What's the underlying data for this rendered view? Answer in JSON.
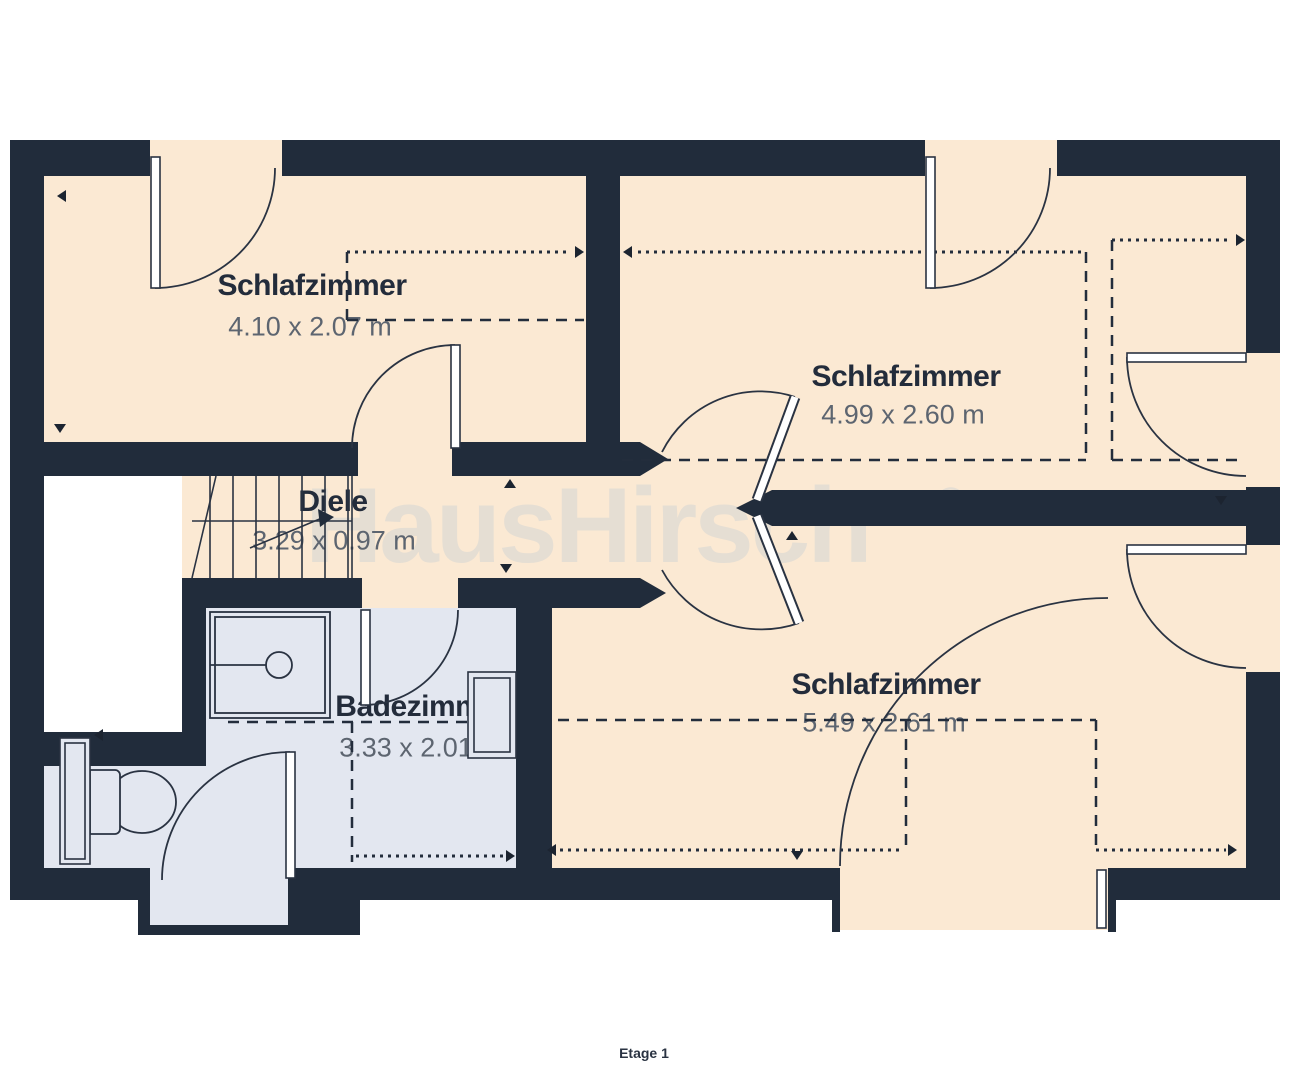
{
  "plan": {
    "brand_watermark": "HausHirsch",
    "registered_mark": "®",
    "floor_label": "Etage 1",
    "rooms": [
      {
        "name": "Schlafzimmer",
        "dimensions": "4.10 x 2.07 m"
      },
      {
        "name": "Schlafzimmer",
        "dimensions": "4.99 x 2.60 m"
      },
      {
        "name": "Diele",
        "dimensions": "3.29 x 0.97 m"
      },
      {
        "name": "Badezimmer",
        "dimensions": "3.33 x 2.01 m"
      },
      {
        "name": "Schlafzimmer",
        "dimensions": "5.49 x 2.61 m"
      }
    ],
    "colors": {
      "wall": "#212c3b",
      "room_floor": "#fbe9d3",
      "bath_floor": "#e3e7f0",
      "watermark": "#e5ded3",
      "label_text": "#232c3b",
      "dimension_text": "#5d6570"
    }
  }
}
